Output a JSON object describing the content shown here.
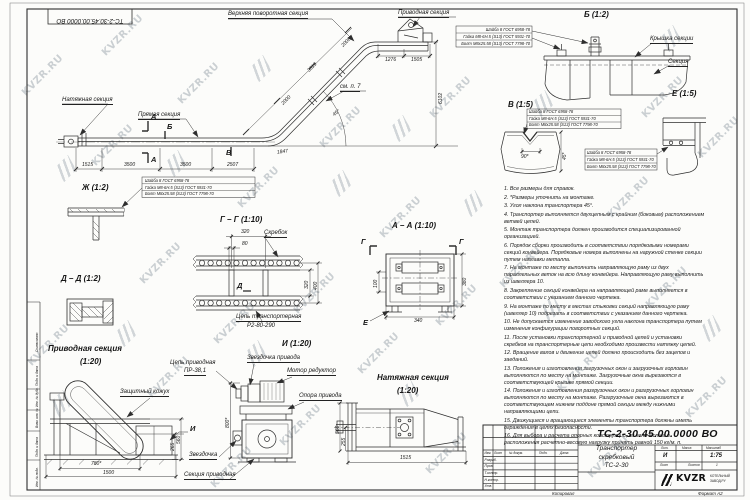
{
  "sheet": {
    "watermark": "KVZR.RU",
    "corner_stamp": "ТС-2-30.45.00.0000 ВО",
    "copied": "Копировал",
    "format": "Формат А2"
  },
  "frame": {
    "approved": "Согласовано",
    "sign_date": "Подп. и дата",
    "inv_dup": "Инв. № дубл.",
    "inv_repl": "Взам. инв. №",
    "sign_date2": "Подп. и дата",
    "inv_orig": "Инв. № подл."
  },
  "main_view": {
    "tension_label": "Натяжная секция",
    "straight_label": "Прямая секция",
    "upper_turn_label": "Верхняя поворотная секция",
    "drive_label": "Приводная секция",
    "see_note": "см. п. 7",
    "mark_a": "А",
    "mark_b": "Б",
    "mark_v": "В",
    "dim_1515": "1515",
    "dim_3500a": "3500",
    "dim_3500b": "3500",
    "dim_2507": "2507",
    "dim_2000": "2000",
    "dim_3519": "3519",
    "dim_2006": "2006",
    "dim_1276": "1276",
    "dim_1505": "1505",
    "dim_6102": "6102",
    "dim_1847": "1847",
    "angle": "45°"
  },
  "fasteners": [
    "Шайба 8 ГОСТ 6958-78",
    "Гайка М8-6Н.5 (S13) ГОСТ 5931-70",
    "Болт М8х25.58 (S13) ГОСТ 7798-70"
  ],
  "detail_zh": {
    "title": "Ж (1:2)"
  },
  "detail_b": {
    "title": "Б (1:2)",
    "cover": "Крышка секции",
    "section": "Секция"
  },
  "detail_v": {
    "title": "В (1:5)",
    "dim_90": "90*",
    "dim_45": "45*"
  },
  "detail_e": {
    "title": "Е (1:5)"
  },
  "section_gg": {
    "title": "Г – Г (1:10)",
    "scraper": "Скребок",
    "dim_320_top": "320",
    "dim_80": "80",
    "dim_320": "320",
    "dim_400": "400",
    "mark_d": "Д",
    "chain1": "Цепь транспортерная",
    "chain2": "Р2-80-290"
  },
  "section_aa": {
    "title": "А – А (1:10)",
    "mark_g": "Г",
    "mark_e": "Е",
    "dim_100": "100",
    "dim_380": "380",
    "dim_340": "340"
  },
  "detail_dd": {
    "title": "Д – Д (1:2)"
  },
  "drive_view": {
    "title": "Приводная секция",
    "scale": "(1:20)",
    "casing": "Защитный кожух",
    "dim_780": "780*",
    "dim_1500": "1500",
    "dim_560": "560",
    "dim_265": "265",
    "mark_i": "И"
  },
  "view_i": {
    "title": "И (1:20)",
    "chain1": "Цепь приводная",
    "chain2": "ПР-38,1",
    "drive_sprocket": "Звездочка привода",
    "motor": "Мотор редуктор",
    "support": "Опора привода",
    "sprocket": "Звездочка",
    "drive_section": "Секция приводная",
    "dim_800": "800*"
  },
  "tension_view": {
    "title": "Натяжная секция",
    "scale": "(1:20)",
    "dim_560": "560",
    "dim_255": "255",
    "dim_1515": "1515"
  },
  "notes": [
    "1. Все размеры для справок.",
    "2. *Размеры уточнить на монтаже.",
    "3. Угол наклона транспортера 45°.",
    "4. Транспортер выполняется двухцепным с крайним (боковым) расположением ветвей цепей.",
    "5. Монтаж транспортера должен производится специализированной организацией.",
    "6. Порядок сборки производить в соответствии порядковыми номерами секций конвейера. Порядковые номера выполнены на наружной стенке секции путем наплавки металла.",
    "7. На монтаже по месту выполнить направляющую раму из двух параллельных веток на всю длину конвейера. Направляющую раму выполнить из швеллера 10.",
    "8. Закрепление секций конвейера на направляющей раме выполняется в соответствии с указанием данного чертежа.",
    "9. На монтаже по месту в местах стыковки секций направляющую раму (швеллер 10) подрезать в соответствии с указанием данного чертежа.",
    "10. Не допускается изменение заводского угла наклона транспортера путем изменения конфигурации поворотных секций.",
    "11. После установки транспортерной и приводной цепей и установки скребков на транспортерные цепи необходимо произвести натяжку цепей.",
    "12. Вращение валов и движение цепей должно происходить без зацепов и заеданий.",
    "13. Положения и изготовления загрузочных окон и загрузочных горловин выполняются по месту на монтаже. Загрузочные окна вырезаются в соответствующей крышке прямой секции.",
    "14. Положения и изготовления разгрузочных окон и разгрузочных горловин выполняются по месту на монтаже. Разгрузочные окна вырезаются в соответствующем нижнем поддоне прямой секции между нижними направляющими цепи.",
    "15. Движущиеся и вращающиеся элементы транспортера должны иметь ограждения в целях безопасности.",
    "16. Для выбора и расчета опорных конструкций, их количества и расположения расчетно-весовую нагрузку принять равной 150 кг/м. п."
  ],
  "title_block": {
    "doc_number": "ТС-2-30.45.00.0000 ВО",
    "name1": "Транспортер",
    "name2": "скребковый",
    "name3": "ТС-2-30",
    "liter": "И",
    "scale": "1:75",
    "sheets_value": "1",
    "h_izm": "Изм.",
    "h_list": "Лист",
    "h_doc": "№ докум.",
    "h_sign": "Подп.",
    "h_date": "Дата",
    "r_razrab": "Разраб.",
    "r_prov": "Пров.",
    "r_tkontr": "Т.контр.",
    "r_nkontr": "Н.контр.",
    "r_utv": "Утв.",
    "h_lit": "Лит.",
    "h_mass": "Масса",
    "h_scale": "Масштаб",
    "h_sheet": "Лист",
    "h_sheets": "Листов",
    "company": "KVZR",
    "company_sub1": "КОТЕЛЬНЫЙ",
    "company_sub2": "ЗАВОД.РУ"
  }
}
